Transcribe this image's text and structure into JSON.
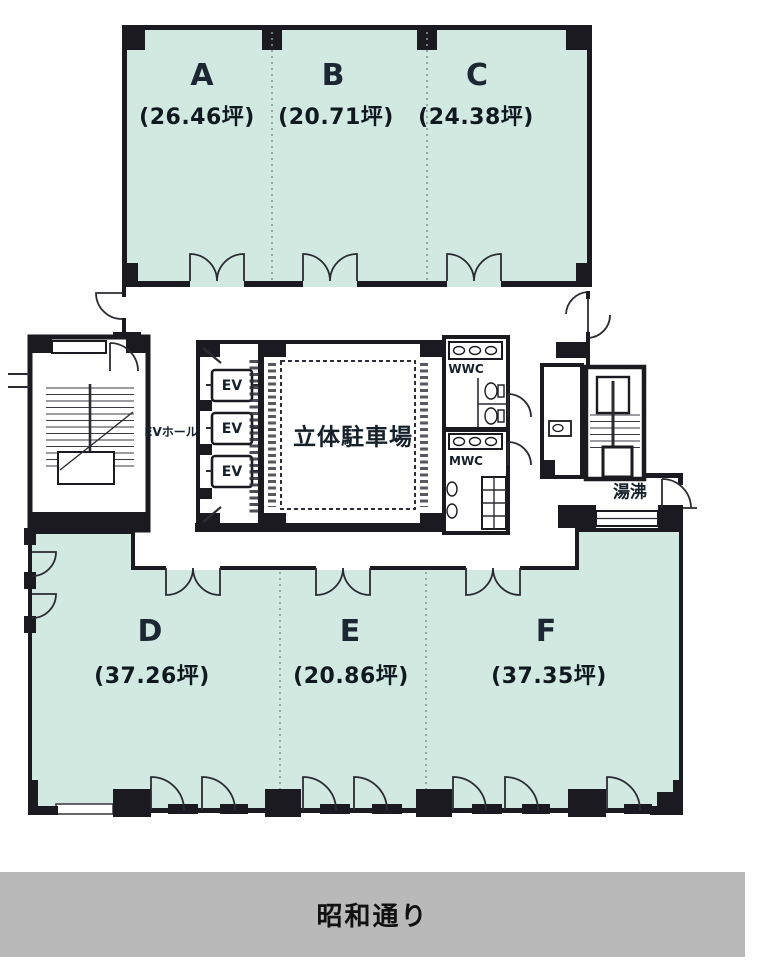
{
  "units": {
    "top": [
      {
        "name": "A",
        "area": "(26.46坪)"
      },
      {
        "name": "B",
        "area": "(20.71坪)"
      },
      {
        "name": "C",
        "area": "(24.38坪)"
      }
    ],
    "bottom": [
      {
        "name": "D",
        "area": "(37.26坪)"
      },
      {
        "name": "E",
        "area": "(20.86坪)"
      },
      {
        "name": "F",
        "area": "(37.35坪)"
      }
    ]
  },
  "core": {
    "ev_hall_label": "EVホール",
    "elevator_labels": [
      "EV",
      "EV",
      "EV"
    ],
    "parking_label": "立体駐車場",
    "womens_wc_label": "WWC",
    "mens_wc_label": "MWC",
    "hot_water_label": "湯沸"
  },
  "street": {
    "label": "昭和通り"
  },
  "colors": {
    "unit_fill": "#d2e9e2",
    "wall": "#1a1a20",
    "street_band": "#b9b9b9"
  }
}
